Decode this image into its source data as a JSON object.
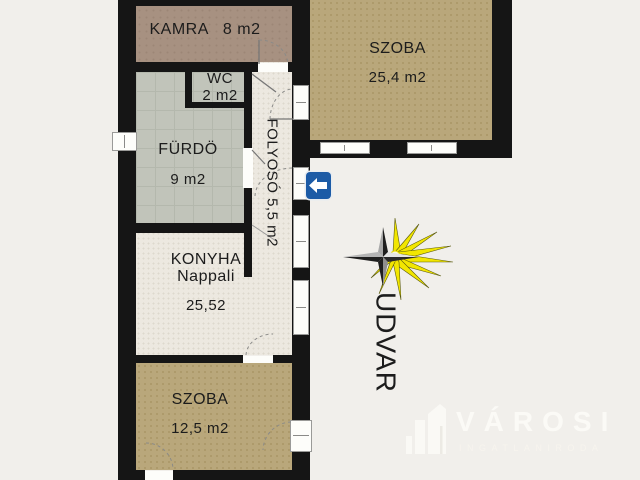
{
  "plan": {
    "rooms": {
      "kamra": {
        "name": "KAMRA",
        "area": "8 m2"
      },
      "wc": {
        "name": "WC",
        "area": "2 m2"
      },
      "furdo": {
        "name": "FÜRDÖ",
        "area": "9 m2"
      },
      "folyoso": {
        "label": "FOLYOSÓ 5,5 m2"
      },
      "szoba_felso": {
        "name": "SZOBA",
        "area": "25,4 m2"
      },
      "konyha": {
        "name": "KONYHA",
        "subname": "Nappali",
        "area": "25,52"
      },
      "szoba_also": {
        "name": "SZOBA",
        "area": "12,5 m2"
      },
      "udvar": {
        "name": "UDVAR"
      }
    },
    "icons": {
      "entrance_arrow": "left-arrow-entrance-sign",
      "compass": "compass-star-with-sun-rays",
      "brand_building": "buildings-logo"
    },
    "watermark": {
      "brand": "VÁROSI",
      "subtitle": "INGATLANIRODA"
    },
    "colors": {
      "background": "#f1efeb",
      "wall": "#151515",
      "room_tan": "#b9a77b",
      "room_taupe": "#a79181",
      "room_gray": "#c1c4ba",
      "floor_light": "#ece8e0",
      "arrow_blue": "#1c5ba6",
      "sun_yellow": "#f2e600",
      "logo_white": "#fbfaf6"
    }
  }
}
